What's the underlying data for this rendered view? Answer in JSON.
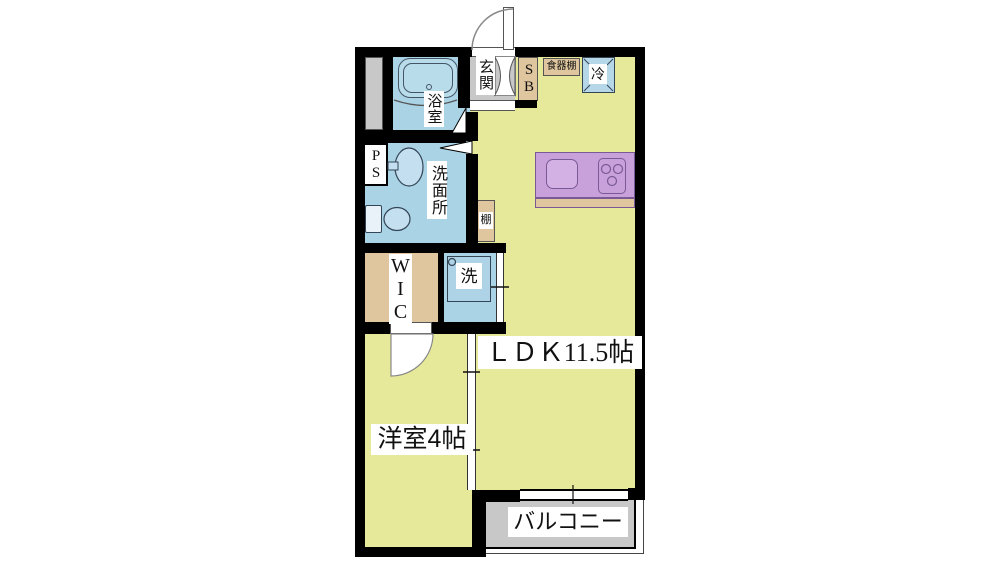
{
  "labels": {
    "ldk": "ＬＤＫ11.5帖",
    "western_room": "洋室4帖",
    "balcony": "バルコニー",
    "bathroom": "浴室",
    "washroom": "洗面所",
    "entrance": "玄関",
    "wic": "WIC",
    "shoe_box": "SB",
    "pipe_space": "PS",
    "cupboard": "食器棚",
    "refrigerator": "冷",
    "washing_machine": "洗",
    "shelf": "棚"
  },
  "colors": {
    "floor": "#e6e89a",
    "wet_area": "#aad3e6",
    "storage": "#dfc69e",
    "kitchen_counter": "#c8a0da",
    "counter_edge": "#dfc69e",
    "concrete": "#c8c8c8",
    "wall": "#000000"
  }
}
